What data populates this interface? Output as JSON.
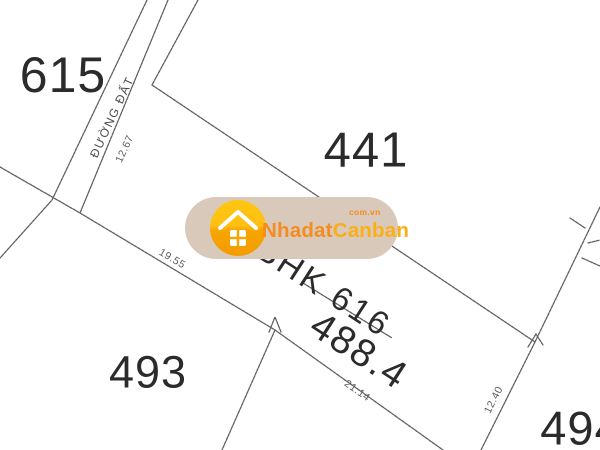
{
  "map": {
    "background": "#ffffff",
    "line_color": "#4a4a4a",
    "parcel_label_color": "#2b2b2b",
    "dimension_label_color": "#5a5a5a"
  },
  "parcels": {
    "northwest": {
      "label": "615"
    },
    "north": {
      "label": "441"
    },
    "southwest": {
      "label": "493"
    },
    "southeast": {
      "label": "494"
    }
  },
  "plot": {
    "land_code": "BHK",
    "number": "616",
    "area": "488.4"
  },
  "road": {
    "name": "ĐƯỜNG ĐẤT"
  },
  "dimensions": {
    "road_frontage": "12.67",
    "northwest_side": "19.55",
    "southwest_side": "21.14",
    "southeast_side": "12.40"
  },
  "watermark": {
    "brand_primary": "Nhadat",
    "brand_secondary": "Canban",
    "domain_suffix": "com.vn",
    "pill_color": "#d8c9ba",
    "brand_primary_color": "#f68b1f",
    "brand_secondary_color": "#fcae17",
    "icon_top_color": "#ffc60f",
    "icon_bottom_color": "#f7a500"
  }
}
